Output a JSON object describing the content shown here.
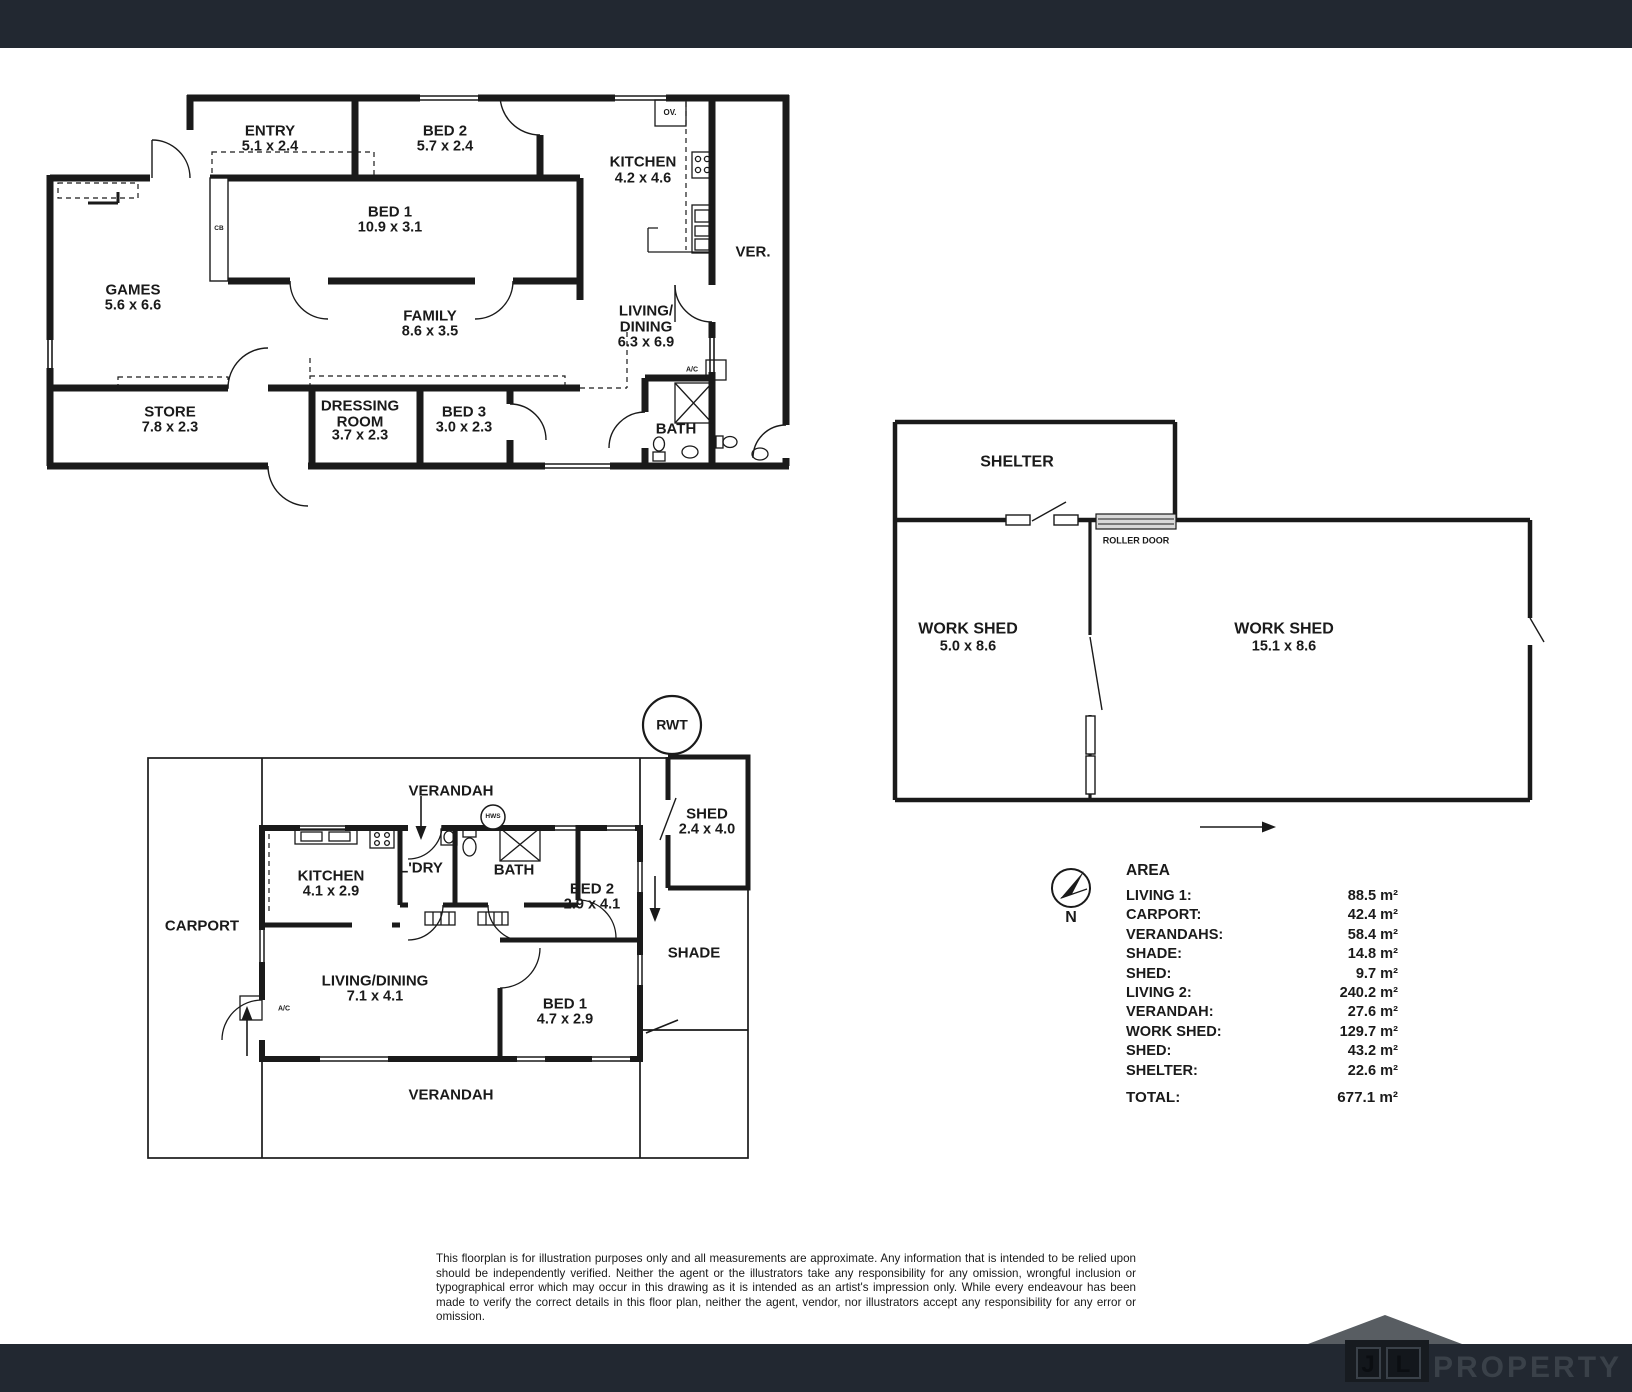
{
  "page": {
    "top_bar_color": "#222831",
    "bottom_bar_color": "#222831",
    "background": "#ffffff",
    "line_color": "#1a1a1a"
  },
  "plan_top": {
    "rooms": [
      {
        "label": "ENTRY",
        "dims": "5.1 x 2.4"
      },
      {
        "label": "BED 2",
        "dims": "5.7 x 2.4"
      },
      {
        "label": "KITCHEN",
        "dims": "4.2 x 4.6"
      },
      {
        "label": "BED 1",
        "dims": "10.9 x 3.1"
      },
      {
        "label": "GAMES",
        "dims": "5.6 x 6.6"
      },
      {
        "label": "FAMILY",
        "dims": "8.6 x 3.5"
      },
      {
        "label": "LIVING/\nDINING",
        "dims": "6.3 x 6.9"
      },
      {
        "label": "STORE",
        "dims": "7.8 x 2.3"
      },
      {
        "label": "DRESSING\nROOM",
        "dims": "3.7 x 2.3"
      },
      {
        "label": "BED 3",
        "dims": "3.0 x 2.3"
      },
      {
        "label": "BATH",
        "dims": ""
      },
      {
        "label": "VER.",
        "dims": ""
      }
    ],
    "annotations": {
      "ov": "OV.",
      "cb": "CB",
      "ac": "A/C"
    }
  },
  "plan_shed": {
    "rooms": [
      {
        "label": "SHELTER",
        "dims": ""
      },
      {
        "label": "WORK SHED",
        "dims": "5.0 x 8.6"
      },
      {
        "label": "WORK SHED",
        "dims": "15.1 x 8.6"
      }
    ],
    "annotations": {
      "roller_door": "ROLLER DOOR"
    }
  },
  "plan_bottom": {
    "rooms": [
      {
        "label": "VERANDAH",
        "dims": ""
      },
      {
        "label": "KITCHEN",
        "dims": "4.1 x 2.9"
      },
      {
        "label": "L'DRY",
        "dims": ""
      },
      {
        "label": "BATH",
        "dims": ""
      },
      {
        "label": "BED 2",
        "dims": "2.9 x 4.1"
      },
      {
        "label": "CARPORT",
        "dims": ""
      },
      {
        "label": "LIVING/DINING",
        "dims": "7.1 x 4.1"
      },
      {
        "label": "BED 1",
        "dims": "4.7 x 2.9"
      },
      {
        "label": "SHED",
        "dims": "2.4 x 4.0"
      },
      {
        "label": "SHADE",
        "dims": ""
      },
      {
        "label": "VERANDAH",
        "dims": ""
      }
    ],
    "annotations": {
      "rwt": "RWT",
      "hws": "HWS",
      "ac": "A/C"
    }
  },
  "compass": {
    "north": "N"
  },
  "area_table": {
    "title": "AREA",
    "rows": [
      {
        "label": "LIVING 1:",
        "value": "88.5 m²"
      },
      {
        "label": "CARPORT:",
        "value": "42.4 m²"
      },
      {
        "label": "VERANDAHS:",
        "value": "58.4 m²"
      },
      {
        "label": "SHADE:",
        "value": "14.8 m²"
      },
      {
        "label": "SHED:",
        "value": "9.7 m²"
      },
      {
        "label": "LIVING 2:",
        "value": "240.2 m²"
      },
      {
        "label": "VERANDAH:",
        "value": "27.6 m²"
      },
      {
        "label": "WORK SHED:",
        "value": "129.7 m²"
      },
      {
        "label": "SHED:",
        "value": "43.2 m²"
      },
      {
        "label": "SHELTER:",
        "value": "22.6 m²"
      }
    ],
    "total": {
      "label": "TOTAL:",
      "value": "677.1 m²"
    }
  },
  "disclaimer": {
    "text": "This floorplan is for illustration purposes only and all measurements are approximate. Any information that is intended to be relied upon should be independently verified. Neither the agent or the illustrators take any responsibility for any omission, wrongful inclusion or typographical error which may occur in this drawing as it is intended as an artist's impression only. While every endeavour has been made to verify the correct details in this floor plan, neither the agent, vendor, nor illustrators accept any responsibility for any error or omission."
  },
  "logo": {
    "initial_j": "J",
    "initial_l": "L",
    "wordmark": "PROPERTY",
    "roof_color": "#585d62",
    "wordmark_color": "#3a4149"
  }
}
